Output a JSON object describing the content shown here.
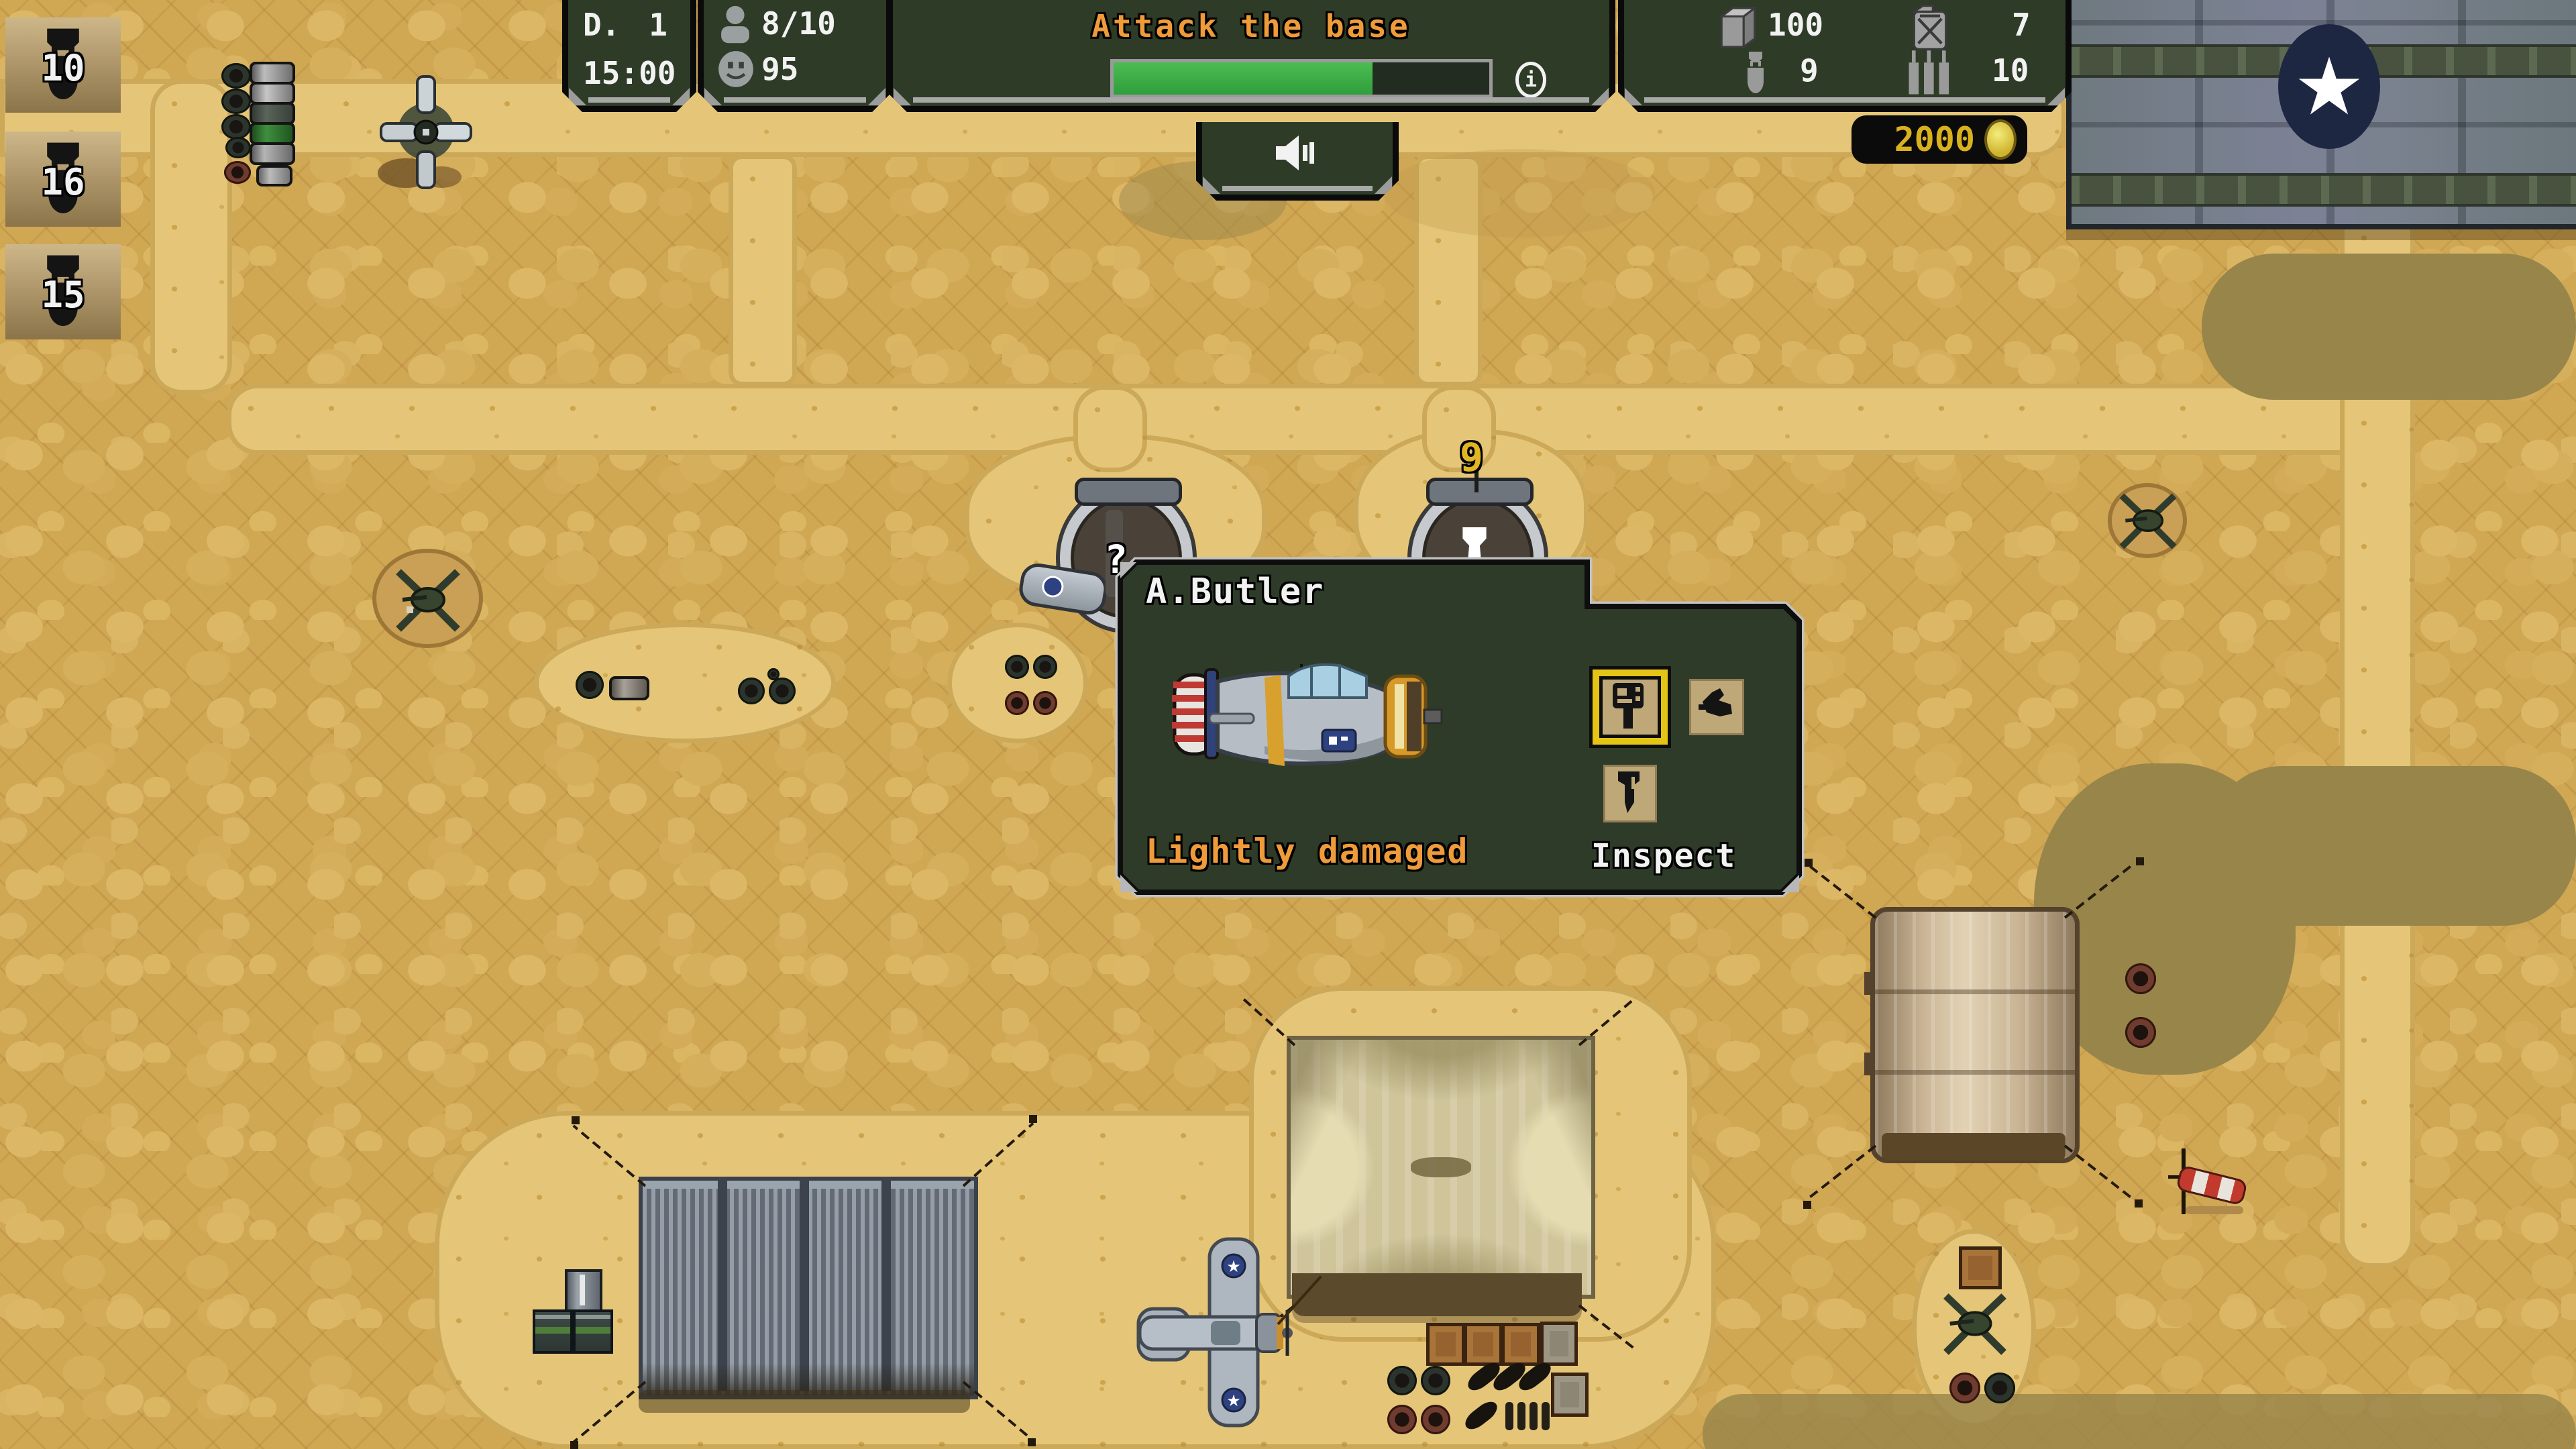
{
  "hud": {
    "day_panel": {
      "day_label": "D.",
      "day_value": "1",
      "time": "15:00"
    },
    "crew_panel": {
      "crew": "8/10",
      "morale": "95"
    },
    "objective": {
      "title": "Attack the base",
      "progress_percent": 69
    },
    "resources": {
      "supplies": "100",
      "bombs": "9",
      "fuel": "7",
      "ammo": "10"
    },
    "money": "2000"
  },
  "bomb_stock": [
    {
      "count": "10"
    },
    {
      "count": "16"
    },
    {
      "count": "15"
    }
  ],
  "map_markers": {
    "hangar_bomb_count": "9",
    "question": "?"
  },
  "dialog": {
    "title": "A.Butler",
    "status": "Lightly damaged",
    "inspect_label": "Inspect"
  },
  "icons": {
    "star": "★",
    "info": "i"
  },
  "colors": {
    "panel_green": "#2d3b27",
    "accent_orange": "#ef9b3a",
    "money_gold": "#d9b11c",
    "highlight_yellow": "#e4c414",
    "progress_green": "#3fae4a"
  }
}
